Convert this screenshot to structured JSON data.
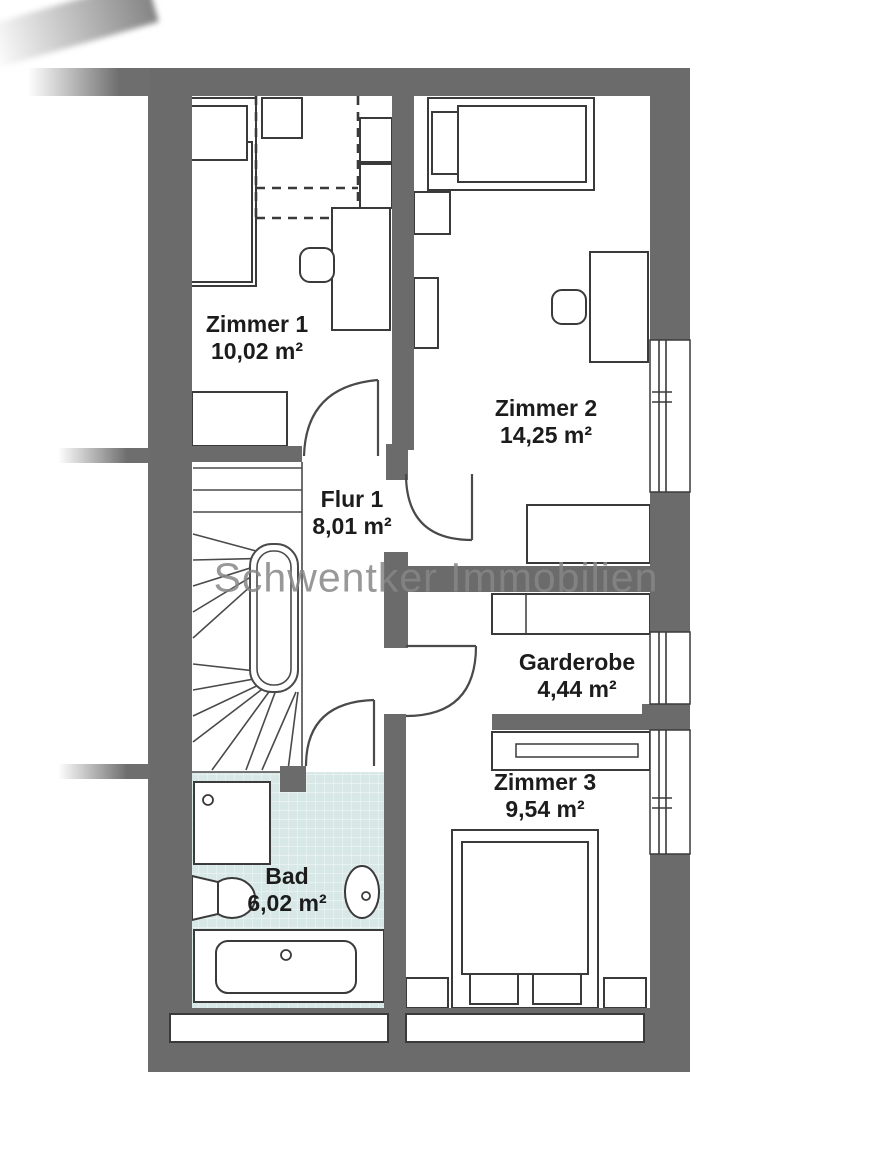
{
  "watermark": "Schwentker Immobilien",
  "rooms": [
    {
      "name": "Zimmer 1",
      "area": "10,02 m²"
    },
    {
      "name": "Zimmer 2",
      "area": "14,25 m²"
    },
    {
      "name": "Flur 1",
      "area": "8,01 m²"
    },
    {
      "name": "Garderobe",
      "area": "4,44 m²"
    },
    {
      "name": "Zimmer 3",
      "area": "9,54 m²"
    },
    {
      "name": "Bad",
      "area": "6,02 m²"
    }
  ],
  "colors": {
    "wall_fill": "#6b6b6b",
    "line": "#3a3a3a",
    "bath_tile": "#d7e8e7",
    "watermark_text": "#878787"
  }
}
